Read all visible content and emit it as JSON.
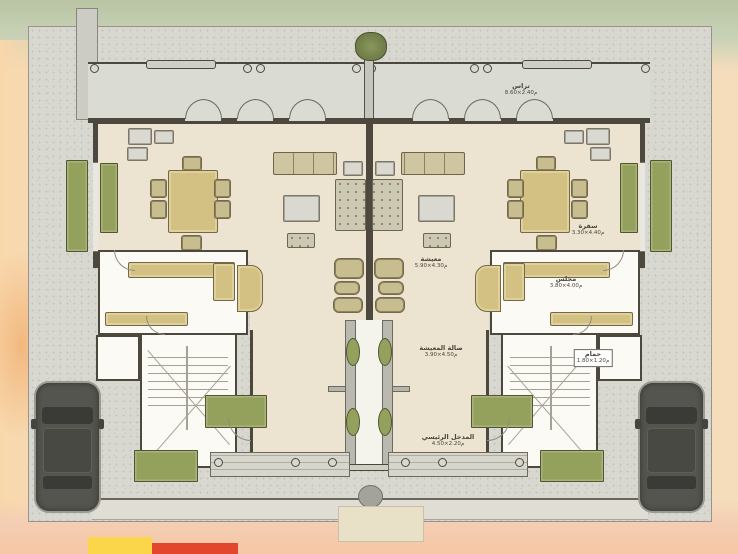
{
  "plan": {
    "kind": "floor-plan",
    "view": "top-down ground floor, twin villa (two mirrored units)",
    "units": 2,
    "cars_parked": 2
  },
  "labels": {
    "terrace": {
      "name": "تراس",
      "dims": "8.60×2.40م"
    },
    "dining": {
      "name": "سفرة",
      "dims": "3.30×4.40م"
    },
    "living": {
      "name": "معيشة",
      "dims": "5.90×4.30م"
    },
    "hall": {
      "name": "صالة المعيشة",
      "dims": "3.90×4.50م"
    },
    "majlis": {
      "name": "مجلس",
      "dims": "3.80×4.00م"
    },
    "bath": {
      "name": "حمام",
      "dims": "1.80×1.20م"
    },
    "entrance": {
      "name": "المدخل الرئيسي",
      "dims": "4.50×2.20م"
    }
  },
  "colors": {
    "walls": "#4c483d",
    "floor_beige": "#ece4d0",
    "terrace_gray": "#dadcd4",
    "lot_gray": "#d8d8d1",
    "room_white": "#fbfaf5",
    "planter_olive": "#93a15d",
    "furniture_tan": "#d3c083",
    "car_gray": "#55554f",
    "bg_green": "#c9d2b7",
    "bg_peach": "#f8d7ab",
    "accent_yellow": "#fcd64a",
    "accent_red": "#e2472e"
  }
}
